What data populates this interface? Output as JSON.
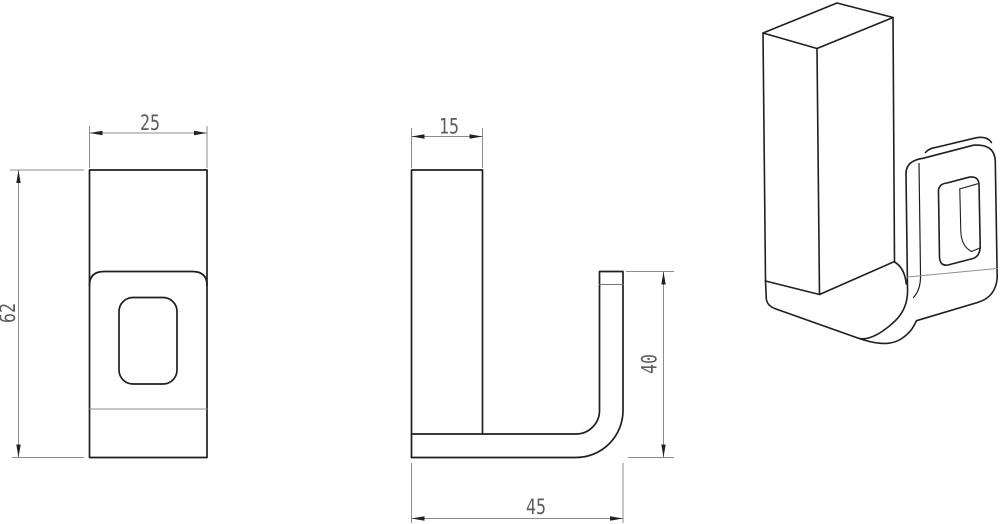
{
  "drawing": {
    "type": "technical-drawing",
    "part": "hook-bracket",
    "background": "#ffffff",
    "line_color": "#1f1f1f",
    "thin_line_color": "#8f8f8f",
    "dim_line_color": "#8c8c8c",
    "arrow_color": "#222222",
    "dim_text_color": "#5c5c5c",
    "dimensions": {
      "width": "25",
      "height": "62",
      "depth": "15",
      "hook_height": "40",
      "base_length": "45"
    },
    "views": {
      "front_view": {
        "label": "front view",
        "width_dim": "25",
        "height_dim": "62"
      },
      "side_view": {
        "label": "side view",
        "depth_dim": "15",
        "hook_height_dim": "40",
        "base_length_dim": "45"
      },
      "iso_view": {
        "label": "isometric view"
      }
    }
  }
}
